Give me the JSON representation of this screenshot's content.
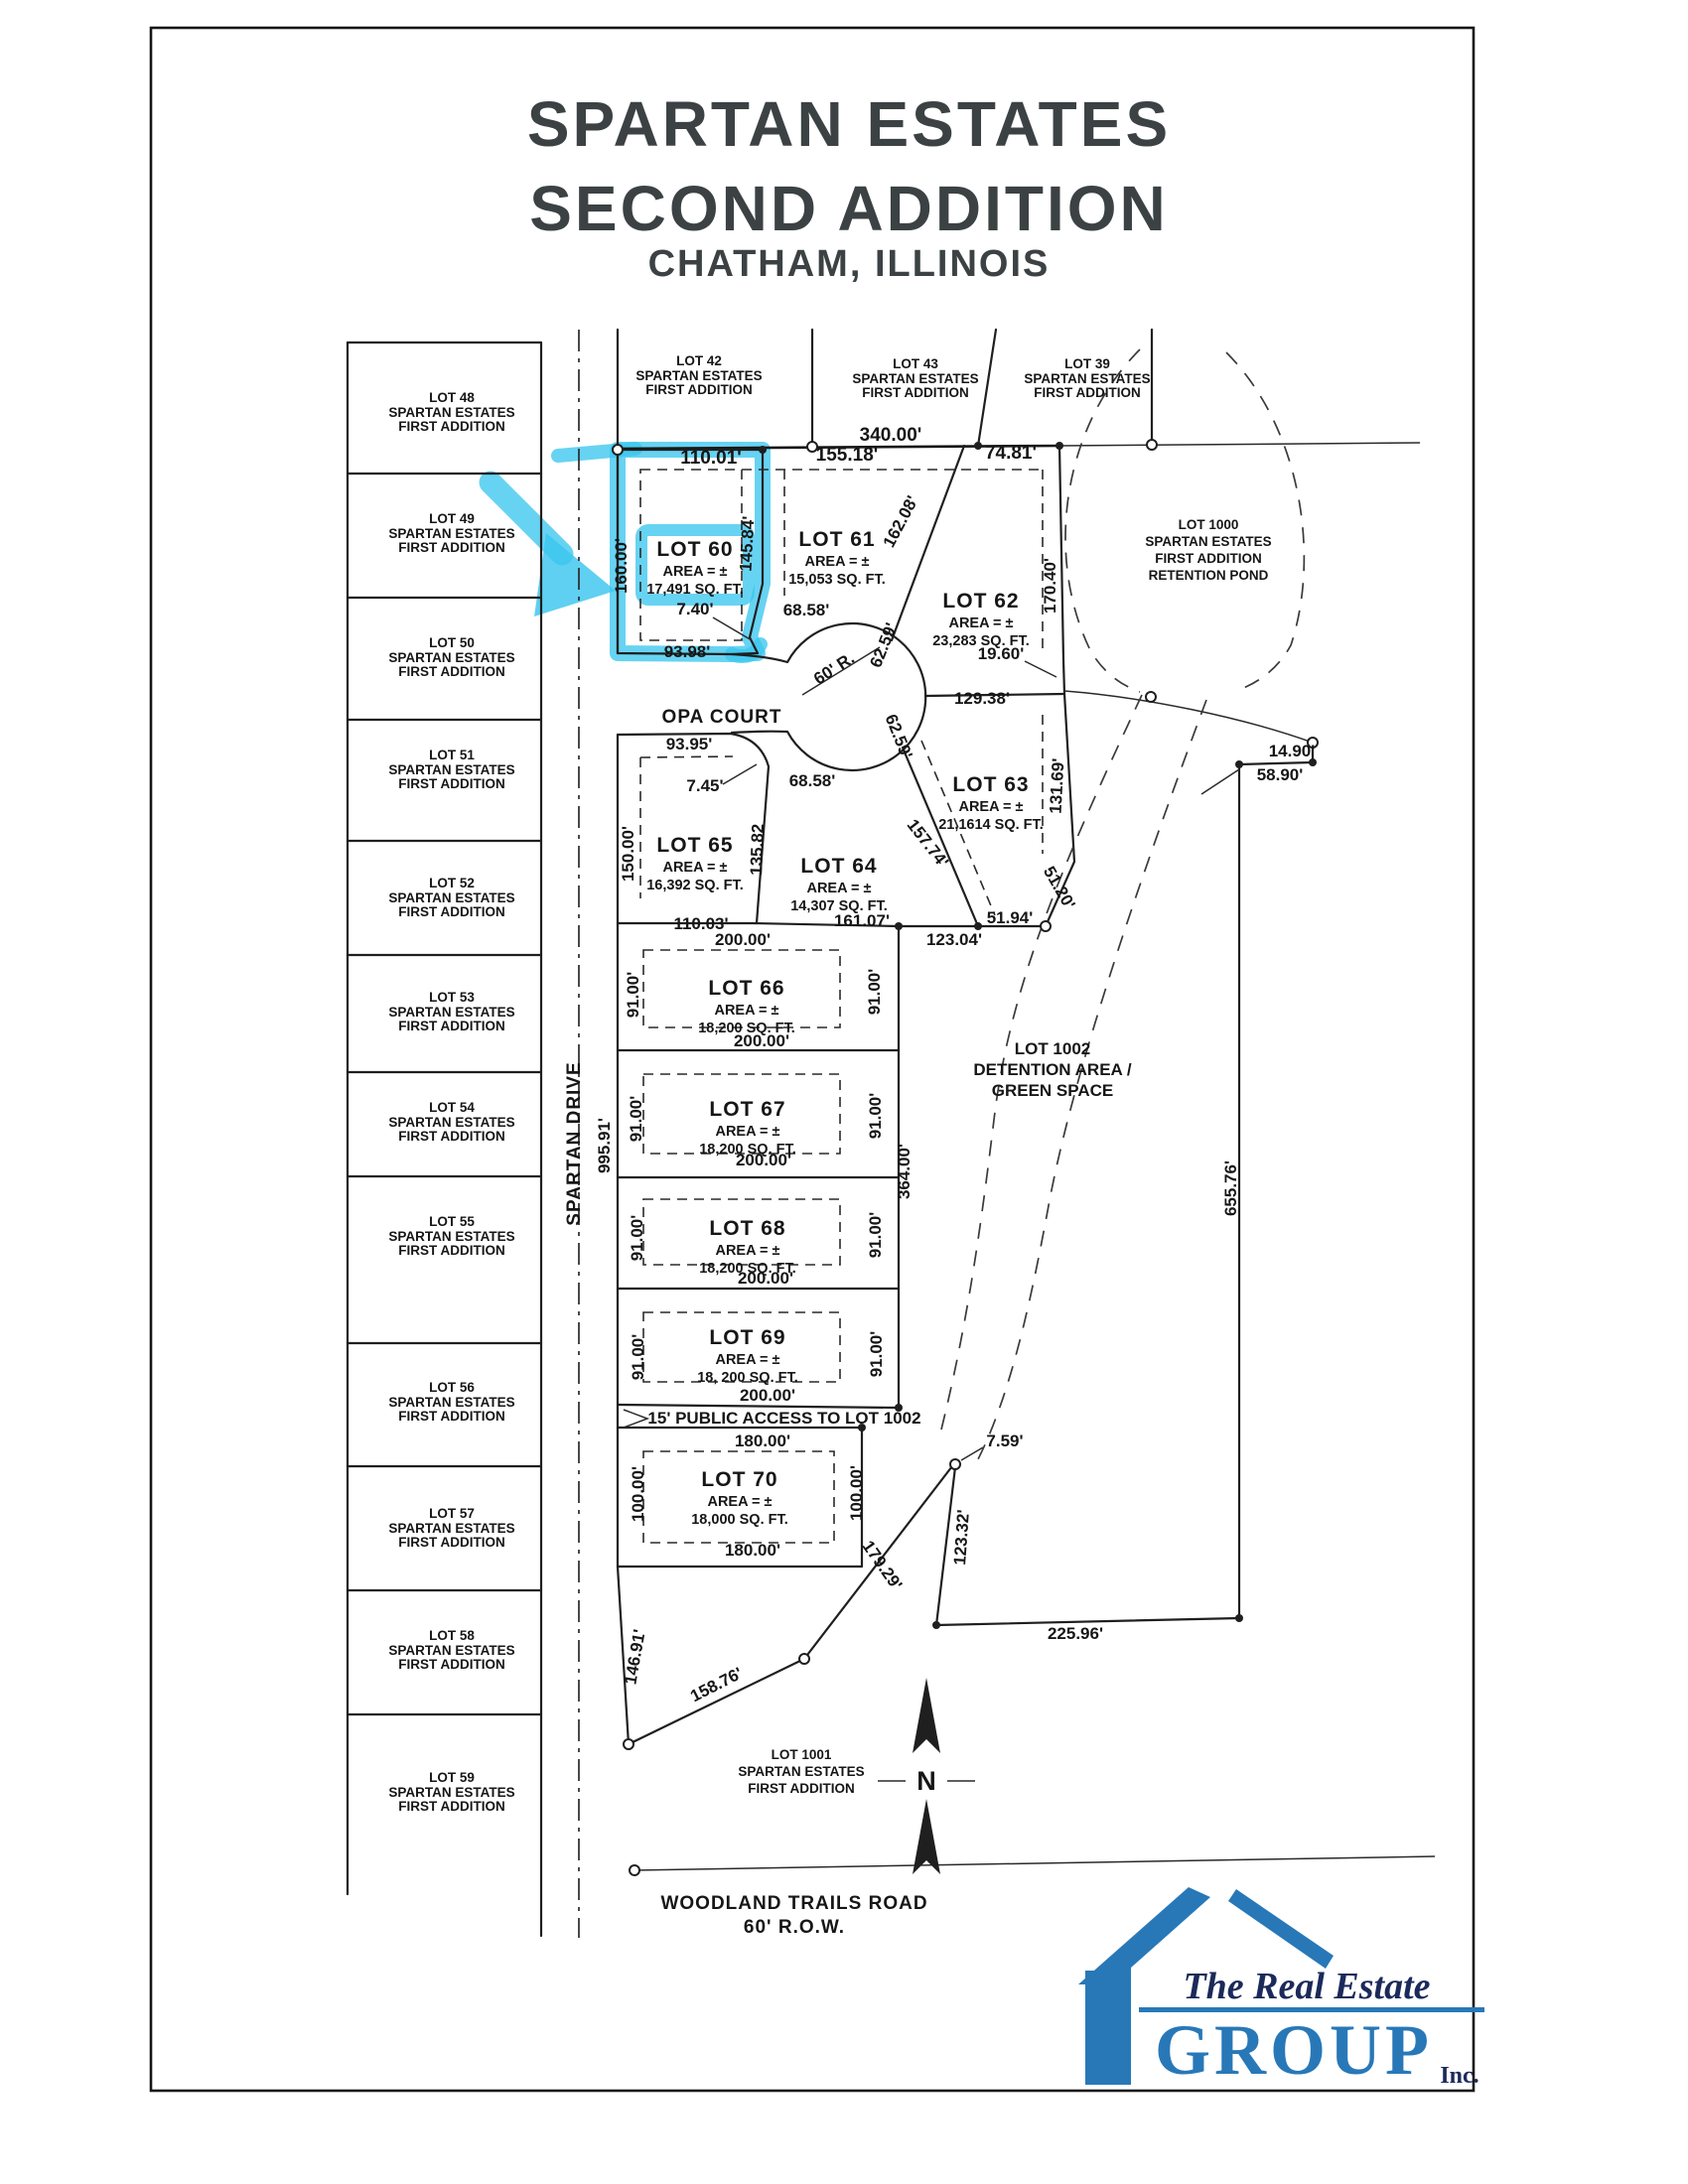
{
  "title": {
    "line1": "SPARTAN ESTATES",
    "line2": "SECOND ADDITION",
    "line3": "CHATHAM, ILLINOIS"
  },
  "top_lots": [
    {
      "name": "LOT 42",
      "sub1": "SPARTAN ESTATES",
      "sub2": "FIRST ADDITION"
    },
    {
      "name": "LOT 43",
      "sub1": "SPARTAN ESTATES",
      "sub2": "FIRST ADDITION"
    },
    {
      "name": "LOT 39",
      "sub1": "SPARTAN ESTATES",
      "sub2": "FIRST ADDITION"
    }
  ],
  "left_lots": [
    {
      "name": "LOT 48",
      "sub1": "SPARTAN ESTATES",
      "sub2": "FIRST ADDITION"
    },
    {
      "name": "LOT 49",
      "sub1": "SPARTAN ESTATES",
      "sub2": "FIRST ADDITION"
    },
    {
      "name": "LOT 50",
      "sub1": "SPARTAN ESTATES",
      "sub2": "FIRST ADDITION"
    },
    {
      "name": "LOT 51",
      "sub1": "SPARTAN ESTATES",
      "sub2": "FIRST ADDITION"
    },
    {
      "name": "LOT 52",
      "sub1": "SPARTAN ESTATES",
      "sub2": "FIRST ADDITION"
    },
    {
      "name": "LOT 53",
      "sub1": "SPARTAN ESTATES",
      "sub2": "FIRST ADDITION"
    },
    {
      "name": "LOT 54",
      "sub1": "SPARTAN ESTATES",
      "sub2": "FIRST ADDITION"
    },
    {
      "name": "LOT 55",
      "sub1": "SPARTAN ESTATES",
      "sub2": "FIRST ADDITION"
    },
    {
      "name": "LOT 56",
      "sub1": "SPARTAN ESTATES",
      "sub2": "FIRST ADDITION"
    },
    {
      "name": "LOT 57",
      "sub1": "SPARTAN ESTATES",
      "sub2": "FIRST ADDITION"
    },
    {
      "name": "LOT 58",
      "sub1": "SPARTAN ESTATES",
      "sub2": "FIRST ADDITION"
    },
    {
      "name": "LOT 59",
      "sub1": "SPARTAN ESTATES",
      "sub2": "FIRST ADDITION"
    }
  ],
  "new_lots": {
    "lot60": {
      "name": "LOT 60",
      "area": "AREA = ±",
      "sqft": "17,491 SQ. FT."
    },
    "lot61": {
      "name": "LOT 61",
      "area": "AREA = ±",
      "sqft": "15,053 SQ. FT."
    },
    "lot62": {
      "name": "LOT 62",
      "area": "AREA = ±",
      "sqft": "23,283 SQ. FT."
    },
    "lot63": {
      "name": "LOT 63",
      "area": "AREA = ±",
      "sqft": "21,1614 SQ. FT."
    },
    "lot64": {
      "name": "LOT 64",
      "area": "AREA = ±",
      "sqft": "14,307 SQ. FT."
    },
    "lot65": {
      "name": "LOT 65",
      "area": "AREA = ±",
      "sqft": "16,392 SQ. FT."
    },
    "lot66": {
      "name": "LOT 66",
      "area": "AREA = ±",
      "sqft": "18,200 SQ. FT."
    },
    "lot67": {
      "name": "LOT 67",
      "area": "AREA = ±",
      "sqft": "18,200 SQ. FT."
    },
    "lot68": {
      "name": "LOT 68",
      "area": "AREA = ±",
      "sqft": "18,200 SQ. FT."
    },
    "lot69": {
      "name": "LOT 69",
      "area": "AREA = ±",
      "sqft": "18, 200 SQ. FT."
    },
    "lot70": {
      "name": "LOT 70",
      "area": "AREA = ±",
      "sqft": "18,000 SQ. FT."
    }
  },
  "special_lots": {
    "lot1000": {
      "l1": "LOT 1000",
      "l2": "SPARTAN ESTATES",
      "l3": "FIRST ADDITION",
      "l4": "RETENTION POND"
    },
    "lot1001": {
      "l1": "LOT 1001",
      "l2": "SPARTAN ESTATES",
      "l3": "FIRST ADDITION"
    },
    "lot1002": {
      "l1": "LOT 1002",
      "l2": "DETENTION AREA /",
      "l3": "GREEN SPACE"
    }
  },
  "roads": {
    "opa_court": "OPA COURT",
    "spartan_drive": "SPARTAN DRIVE",
    "woodland1": "WOODLAND TRAILS ROAD",
    "woodland2": "60' R.O.W.",
    "radius": "60' R.",
    "access": "15' PUBLIC ACCESS TO LOT 1002"
  },
  "dims": {
    "d340": "340.00'",
    "d110_01": "110.01'",
    "d155_18": "155.18'",
    "d74_81": "74.81'",
    "d160_00": "160.00'",
    "d145_84": "145.84'",
    "d162_08": "162.08'",
    "d170_40": "170.40'",
    "d7_40": "7.40'",
    "d68_58a": "68.58'",
    "d93_98": "93.98'",
    "d62_59a": "62.59'",
    "d19_60": "19.60'",
    "d129_38": "129.38'",
    "d14_90": "14.90'",
    "d58_90": "58.90'",
    "d93_95": "93.95'",
    "d7_45": "7.45'",
    "d68_58b": "68.58'",
    "d62_59b": "62.59'",
    "d131_69": "131.69'",
    "d150_00": "150.00'",
    "d135_82": "135.82",
    "d157_74": "157.74'",
    "d51_20": "51.20'",
    "d110_03": "110.03'",
    "d161_07": "161.07'",
    "d51_94": "51.94'",
    "d123_04": "123.04'",
    "d200a": "200.00'",
    "d200b": "200.00'",
    "d200c": "200.00'",
    "d200d": "200.00'",
    "d200e": "200.00'",
    "d91a_l": "91.00'",
    "d91a_r": "91.00'",
    "d91b_l": "91.00'",
    "d91b_r": "91.00'",
    "d91c_l": "91.00'",
    "d91c_r": "91.00'",
    "d91d_l": "91.00'",
    "d91d_r": "91.00'",
    "d364_00": "364.00'",
    "d995_91": "995.91'",
    "d180a": "180.00'",
    "d180b": "180.00'",
    "d100_l": "100.00'",
    "d100_r": "100.00'",
    "d7_59": "7.59'",
    "d123_32": "123.32'",
    "d179_29": "179.29'",
    "d225_96": "225.96'",
    "d146_91": "146.91'",
    "d158_76": "158.76'",
    "d655_76": "655.76'"
  },
  "north_label": "N",
  "logo": {
    "line1": "The Real Estate",
    "line2": "GROUP",
    "line3": "Inc."
  },
  "colors": {
    "highlight": "#3cc6ee",
    "logo_blue": "#2878b8",
    "logo_navy": "#1b2a5a",
    "ink": "#1f1f1f",
    "title_ink": "#3c4244"
  }
}
